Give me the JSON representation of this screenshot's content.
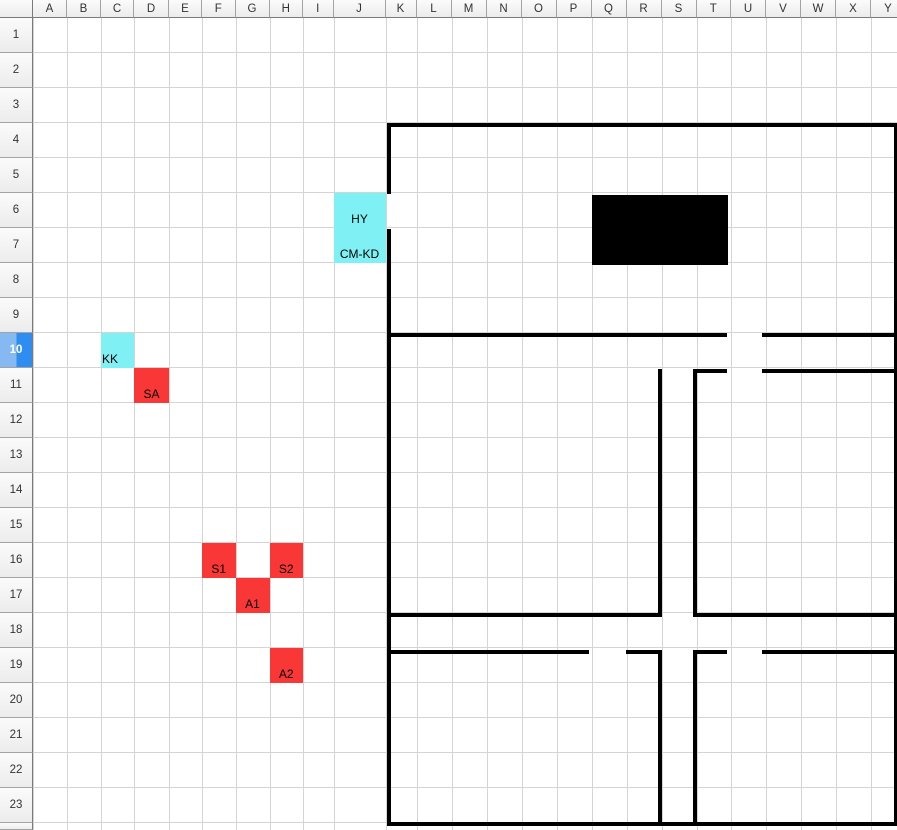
{
  "sheet": {
    "columns": [
      "A",
      "B",
      "C",
      "D",
      "E",
      "F",
      "G",
      "H",
      "I",
      "J",
      "K",
      "L",
      "M",
      "N",
      "O",
      "P",
      "Q",
      "R",
      "S",
      "T",
      "U",
      "V",
      "W",
      "X",
      "Y"
    ],
    "rows": [
      "1",
      "2",
      "3",
      "4",
      "5",
      "6",
      "7",
      "8",
      "9",
      "10",
      "11",
      "12",
      "13",
      "14",
      "15",
      "16",
      "17",
      "18",
      "19",
      "20",
      "21",
      "22",
      "23"
    ],
    "selected_row": "10"
  },
  "cells": [
    {
      "ref": "J6",
      "label": "HY",
      "fill": "cyan",
      "align": "center"
    },
    {
      "ref": "J7",
      "label": "CM-KD",
      "fill": "cyan",
      "align": "center"
    },
    {
      "ref": "C10",
      "label": "KK",
      "fill": "cyan",
      "align": "left"
    },
    {
      "ref": "D11",
      "label": "SA",
      "fill": "red",
      "align": "center"
    },
    {
      "ref": "F16",
      "label": "S1",
      "fill": "red",
      "align": "center"
    },
    {
      "ref": "H16",
      "label": "S2",
      "fill": "red",
      "align": "center"
    },
    {
      "ref": "G17",
      "label": "A1",
      "fill": "red",
      "align": "center"
    },
    {
      "ref": "H19",
      "label": "A2",
      "fill": "red",
      "align": "center"
    }
  ],
  "colors": {
    "cyan": "#7FF0F4",
    "red": "#F93737",
    "wall": "#000000",
    "gridline": "#d4d4d4",
    "selected_header_left": "#86b9f1",
    "selected_header_right": "#2f8cf0"
  },
  "floor_plan": {
    "wall_thickness": 4,
    "h_walls": [
      {
        "x": 387,
        "y": 123,
        "w": 510
      },
      {
        "x": 387,
        "y": 333,
        "w": 340
      },
      {
        "x": 762,
        "y": 333,
        "w": 135
      },
      {
        "x": 692.5,
        "y": 369,
        "w": 34.5
      },
      {
        "x": 762,
        "y": 369,
        "w": 135
      },
      {
        "x": 387,
        "y": 613,
        "w": 275
      },
      {
        "x": 692.5,
        "y": 613,
        "w": 204.5
      },
      {
        "x": 387,
        "y": 650,
        "w": 201.5
      },
      {
        "x": 625.5,
        "y": 650,
        "w": 36.5
      },
      {
        "x": 692.5,
        "y": 650,
        "w": 34.5
      },
      {
        "x": 762,
        "y": 650,
        "w": 135
      },
      {
        "x": 387,
        "y": 822,
        "w": 510
      }
    ],
    "v_walls": [
      {
        "x": 387,
        "y": 123,
        "h": 71
      },
      {
        "x": 387,
        "y": 229,
        "h": 597
      },
      {
        "x": 658,
        "y": 369,
        "h": 248
      },
      {
        "x": 658,
        "y": 650,
        "h": 176
      },
      {
        "x": 692.5,
        "y": 369,
        "h": 248
      },
      {
        "x": 692.5,
        "y": 650,
        "h": 176
      },
      {
        "x": 893.5,
        "y": 123,
        "h": 703
      }
    ],
    "solid_rect": {
      "x": 591.5,
      "y": 195,
      "w": 136,
      "h": 70
    }
  }
}
